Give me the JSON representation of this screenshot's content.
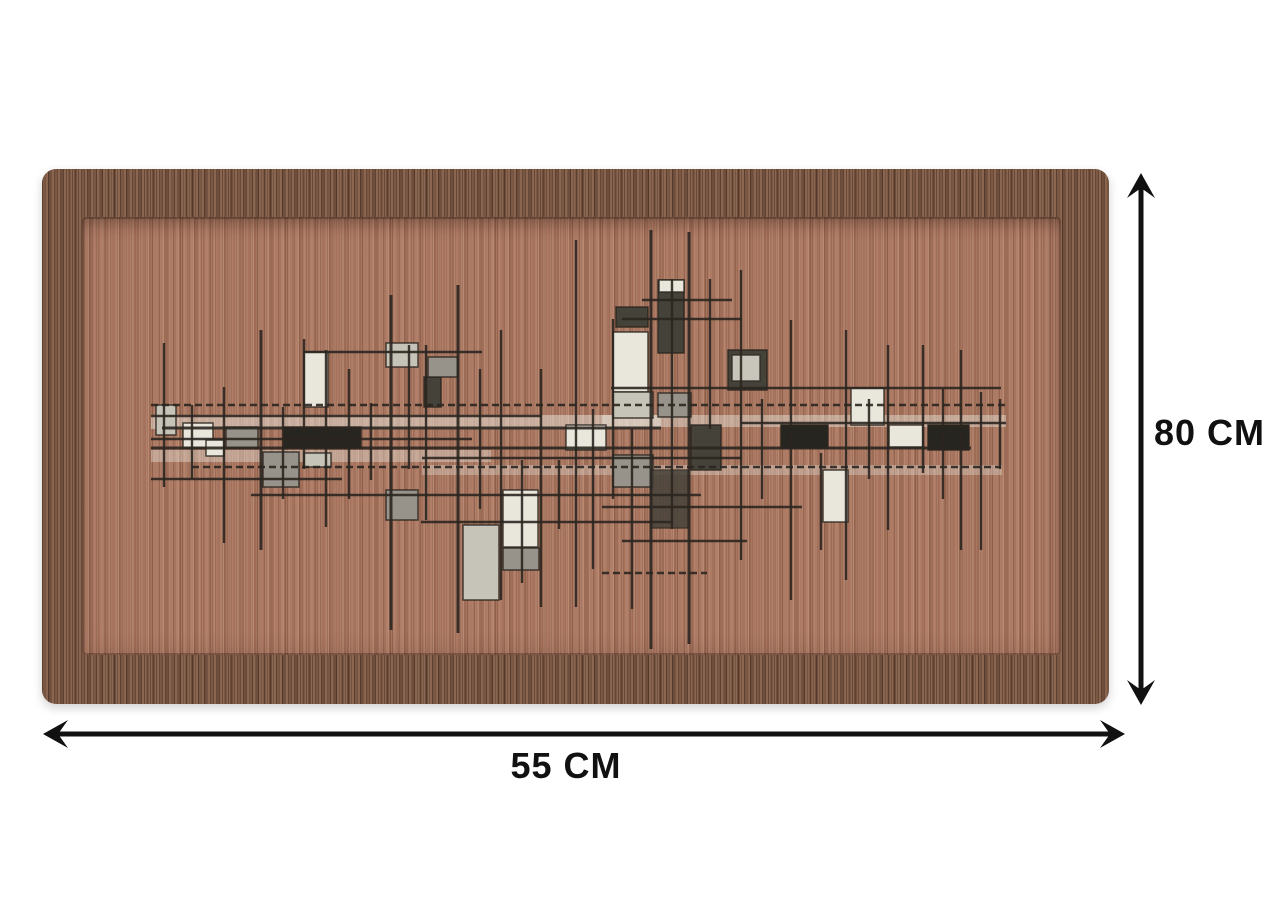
{
  "product": {
    "description": "rectangular rug with abstract geometric line pattern, shown with dimension arrows"
  },
  "dimensions": {
    "width_label": "55 CM",
    "height_label": "80 CM",
    "arrow_color": "#111111",
    "label_color": "#111111"
  },
  "rug_colors": {
    "border_band": "#7b5844",
    "field": "#a7735d",
    "pattern_line": "#2b2620",
    "pattern_white": "#e9e6dc",
    "pattern_light_gray": "#c6c3b8",
    "pattern_mid_gray": "#97938a",
    "pattern_dark_gray": "#45423a",
    "pattern_black": "#27251f"
  },
  "rug_pattern": {
    "viewbox": "0 0 1067 535",
    "palette": {
      "w": "#e9e6dc",
      "l": "#c6c3b8",
      "m": "#97938a",
      "d": "#45423a",
      "k": "#27251f"
    },
    "line_color": "#2b2620",
    "streaks": [
      {
        "x": 109,
        "y": 246,
        "w": 510,
        "h": 14,
        "f": "w",
        "o": 0.5
      },
      {
        "x": 560,
        "y": 246,
        "w": 404,
        "h": 12,
        "f": "w",
        "o": 0.45
      },
      {
        "x": 109,
        "y": 281,
        "w": 340,
        "h": 12,
        "f": "w",
        "o": 0.4
      },
      {
        "x": 380,
        "y": 296,
        "w": 580,
        "h": 10,
        "f": "w",
        "o": 0.35
      }
    ],
    "rects": [
      {
        "x": 262,
        "y": 183,
        "w": 24,
        "h": 55,
        "f": "w"
      },
      {
        "x": 344,
        "y": 174,
        "w": 32,
        "h": 24,
        "f": "l"
      },
      {
        "x": 382,
        "y": 208,
        "w": 17,
        "h": 30,
        "f": "d"
      },
      {
        "x": 386,
        "y": 188,
        "w": 30,
        "h": 20,
        "f": "m"
      },
      {
        "x": 141,
        "y": 254,
        "w": 30,
        "h": 25,
        "f": "w"
      },
      {
        "x": 184,
        "y": 258,
        "w": 32,
        "h": 21,
        "f": "m"
      },
      {
        "x": 242,
        "y": 258,
        "w": 77,
        "h": 21,
        "f": "k"
      },
      {
        "x": 221,
        "y": 283,
        "w": 36,
        "h": 35,
        "f": "m"
      },
      {
        "x": 262,
        "y": 284,
        "w": 27,
        "h": 14,
        "f": "l"
      },
      {
        "x": 344,
        "y": 321,
        "w": 32,
        "h": 30,
        "f": "m"
      },
      {
        "x": 571,
        "y": 163,
        "w": 35,
        "h": 60,
        "f": "w"
      },
      {
        "x": 574,
        "y": 138,
        "w": 32,
        "h": 20,
        "f": "d"
      },
      {
        "x": 616,
        "y": 111,
        "w": 26,
        "h": 73,
        "f": "d"
      },
      {
        "x": 617,
        "y": 111,
        "w": 25,
        "h": 12,
        "f": "w"
      },
      {
        "x": 686,
        "y": 181,
        "w": 39,
        "h": 40,
        "f": "d"
      },
      {
        "x": 690,
        "y": 186,
        "w": 28,
        "h": 26,
        "f": "w",
        "o": 0.8
      },
      {
        "x": 809,
        "y": 219,
        "w": 33,
        "h": 37,
        "f": "w"
      },
      {
        "x": 739,
        "y": 256,
        "w": 47,
        "h": 23,
        "f": "k"
      },
      {
        "x": 847,
        "y": 256,
        "w": 34,
        "h": 22,
        "f": "w"
      },
      {
        "x": 886,
        "y": 256,
        "w": 41,
        "h": 25,
        "f": "k"
      },
      {
        "x": 781,
        "y": 301,
        "w": 25,
        "h": 52,
        "f": "w"
      },
      {
        "x": 421,
        "y": 356,
        "w": 36,
        "h": 75,
        "f": "l"
      },
      {
        "x": 461,
        "y": 321,
        "w": 35,
        "h": 57,
        "f": "w"
      },
      {
        "x": 461,
        "y": 379,
        "w": 36,
        "h": 22,
        "f": "m"
      },
      {
        "x": 616,
        "y": 224,
        "w": 33,
        "h": 24,
        "f": "m"
      },
      {
        "x": 571,
        "y": 223,
        "w": 40,
        "h": 26,
        "f": "l"
      },
      {
        "x": 649,
        "y": 256,
        "w": 30,
        "h": 45,
        "f": "d"
      },
      {
        "x": 524,
        "y": 256,
        "w": 40,
        "h": 25,
        "f": "w"
      },
      {
        "x": 114,
        "y": 236,
        "w": 20,
        "h": 30,
        "f": "l"
      },
      {
        "x": 571,
        "y": 286,
        "w": 40,
        "h": 32,
        "f": "m"
      },
      {
        "x": 609,
        "y": 301,
        "w": 37,
        "h": 58,
        "f": "d",
        "o": 0.85
      },
      {
        "x": 164,
        "y": 271,
        "w": 18,
        "h": 16,
        "f": "w"
      }
    ],
    "vlines": [
      {
        "x": 122,
        "y1": 174,
        "y2": 318
      },
      {
        "x": 150,
        "y1": 236,
        "y2": 310
      },
      {
        "x": 182,
        "y1": 218,
        "y2": 374
      },
      {
        "x": 219,
        "y1": 161,
        "y2": 381,
        "t": 3
      },
      {
        "x": 241,
        "y1": 238,
        "y2": 330
      },
      {
        "x": 262,
        "y1": 170,
        "y2": 300
      },
      {
        "x": 284,
        "y1": 181,
        "y2": 358
      },
      {
        "x": 307,
        "y1": 200,
        "y2": 330
      },
      {
        "x": 329,
        "y1": 234,
        "y2": 311
      },
      {
        "x": 349,
        "y1": 126,
        "y2": 461,
        "t": 3
      },
      {
        "x": 367,
        "y1": 176,
        "y2": 300
      },
      {
        "x": 384,
        "y1": 176,
        "y2": 351
      },
      {
        "x": 416,
        "y1": 116,
        "y2": 464,
        "t": 3
      },
      {
        "x": 438,
        "y1": 200,
        "y2": 340
      },
      {
        "x": 459,
        "y1": 161,
        "y2": 431
      },
      {
        "x": 480,
        "y1": 291,
        "y2": 414
      },
      {
        "x": 499,
        "y1": 200,
        "y2": 438
      },
      {
        "x": 517,
        "y1": 291,
        "y2": 360
      },
      {
        "x": 534,
        "y1": 71,
        "y2": 438
      },
      {
        "x": 551,
        "y1": 240,
        "y2": 400
      },
      {
        "x": 571,
        "y1": 150,
        "y2": 330
      },
      {
        "x": 590,
        "y1": 260,
        "y2": 440
      },
      {
        "x": 609,
        "y1": 61,
        "y2": 480,
        "t": 3
      },
      {
        "x": 630,
        "y1": 110,
        "y2": 360
      },
      {
        "x": 647,
        "y1": 63,
        "y2": 475,
        "t": 3
      },
      {
        "x": 668,
        "y1": 110,
        "y2": 260
      },
      {
        "x": 699,
        "y1": 101,
        "y2": 391
      },
      {
        "x": 720,
        "y1": 230,
        "y2": 330
      },
      {
        "x": 749,
        "y1": 151,
        "y2": 431
      },
      {
        "x": 779,
        "y1": 284,
        "y2": 381
      },
      {
        "x": 804,
        "y1": 161,
        "y2": 411
      },
      {
        "x": 827,
        "y1": 230,
        "y2": 310
      },
      {
        "x": 846,
        "y1": 176,
        "y2": 361
      },
      {
        "x": 881,
        "y1": 176,
        "y2": 304
      },
      {
        "x": 901,
        "y1": 220,
        "y2": 330
      },
      {
        "x": 919,
        "y1": 181,
        "y2": 381
      },
      {
        "x": 939,
        "y1": 223,
        "y2": 381
      },
      {
        "x": 958,
        "y1": 230,
        "y2": 300
      }
    ],
    "hlines": [
      {
        "y": 131,
        "x1": 600,
        "x2": 690
      },
      {
        "y": 150,
        "x1": 580,
        "x2": 700
      },
      {
        "y": 183,
        "x1": 262,
        "x2": 440
      },
      {
        "y": 219,
        "x1": 569,
        "x2": 959
      },
      {
        "y": 236,
        "x1": 109,
        "x2": 964,
        "d": 1
      },
      {
        "y": 247,
        "x1": 109,
        "x2": 500
      },
      {
        "y": 254,
        "x1": 699,
        "x2": 964
      },
      {
        "y": 259,
        "x1": 120,
        "x2": 619,
        "t": 3
      },
      {
        "y": 270,
        "x1": 109,
        "x2": 430
      },
      {
        "y": 279,
        "x1": 109,
        "x2": 929,
        "t": 3
      },
      {
        "y": 289,
        "x1": 380,
        "x2": 700
      },
      {
        "y": 298,
        "x1": 150,
        "x2": 959,
        "d": 1
      },
      {
        "y": 310,
        "x1": 109,
        "x2": 300
      },
      {
        "y": 326,
        "x1": 209,
        "x2": 659
      },
      {
        "y": 338,
        "x1": 560,
        "x2": 760
      },
      {
        "y": 353,
        "x1": 379,
        "x2": 630
      },
      {
        "y": 372,
        "x1": 580,
        "x2": 705
      },
      {
        "y": 404,
        "x1": 560,
        "x2": 665,
        "d": 1
      }
    ]
  }
}
